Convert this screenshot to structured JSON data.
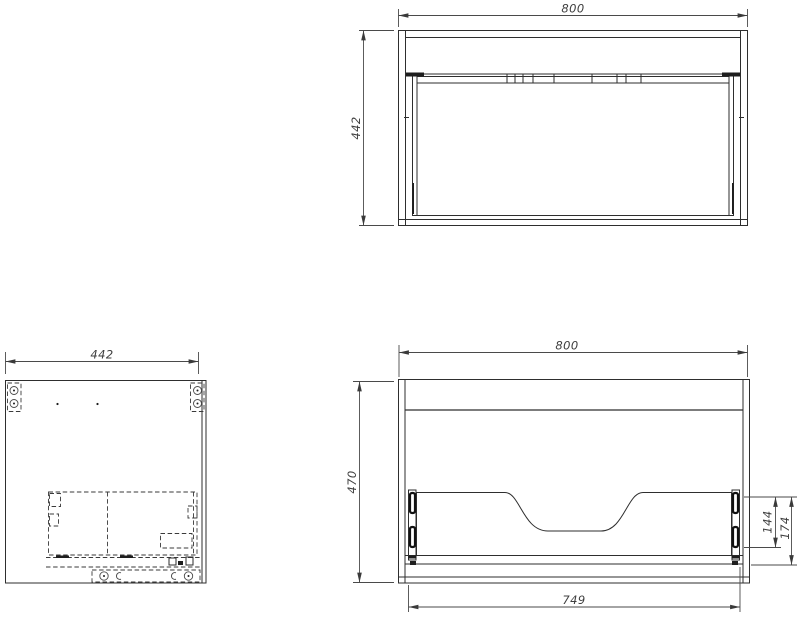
{
  "drawing": {
    "kind": "cabinet technical drawing, three orthographic views",
    "background_color": "#ffffff",
    "line_color": "#2e2e2e"
  },
  "views": {
    "top": {
      "name": "top view",
      "width_label": "800",
      "depth_label": "442"
    },
    "side": {
      "name": "side view",
      "width_label": "442"
    },
    "front": {
      "name": "front view",
      "width_label": "800",
      "height_label": "470",
      "bottom_width_label": "749",
      "right_inner_label": "144",
      "right_outer_label": "174"
    }
  }
}
